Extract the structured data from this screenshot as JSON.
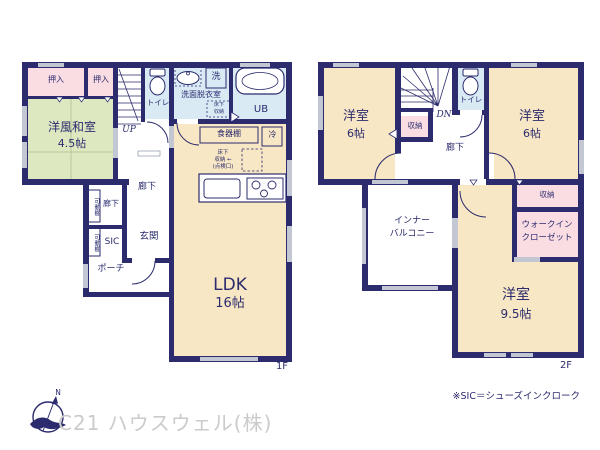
{
  "f1": {
    "floor_label": "1F",
    "oshiire_a": "押入",
    "oshiire_b": "押入",
    "washitsu_name": "洋風和室",
    "washitsu_size": "4.5帖",
    "up": "UP",
    "toilet": "トイレ",
    "ps": "PS",
    "washer": "洗",
    "senmen": "洗面脱衣室",
    "yukashita_line1": "床下",
    "yukashita_line2": "収納",
    "ub": "UB",
    "shokkidana": "食器棚",
    "fridge": "冷",
    "yukashita_k1": "床下",
    "yukashita_k2": "収納 ←",
    "yukashita_k3": "(点検口)",
    "rouka": "廊下",
    "rouka_small": "廊下",
    "kadoudana_a": "可動棚",
    "kadoudana_b": "可動棚",
    "sic": "SIC",
    "genkan": "玄関",
    "porch": "ポーチ",
    "ldk_name": "LDK",
    "ldk_size": "16帖"
  },
  "f2": {
    "floor_label": "2F",
    "room_a_name": "洋室",
    "room_a_size": "6帖",
    "dn": "DN",
    "closet_stairs": "収納",
    "toilet": "トイレ",
    "room_b_name": "洋室",
    "room_b_size": "6帖",
    "rouka": "廊下",
    "balcony_line1": "インナー",
    "balcony_line2": "バルコニー",
    "closet": "収納",
    "wic_line1": "ウォークイン",
    "wic_line2": "クローゼット",
    "room_c_name": "洋室",
    "room_c_size": "9.5帖"
  },
  "footer": {
    "sic_note": "※SIC＝シューズインクローク",
    "company": "C21 ハウスウェル(株)",
    "compass_n": "N"
  },
  "colors": {
    "wall": "#2b2b6e",
    "room_cream": "#f7e7c4",
    "room_green": "#dde8c1",
    "closet_pink": "#fadde3",
    "wet_blue": "#d9eaf5",
    "window_gray": "#c3c7d4",
    "tatami_line": "#b9c69a",
    "watermark": "#cbcbcb"
  }
}
